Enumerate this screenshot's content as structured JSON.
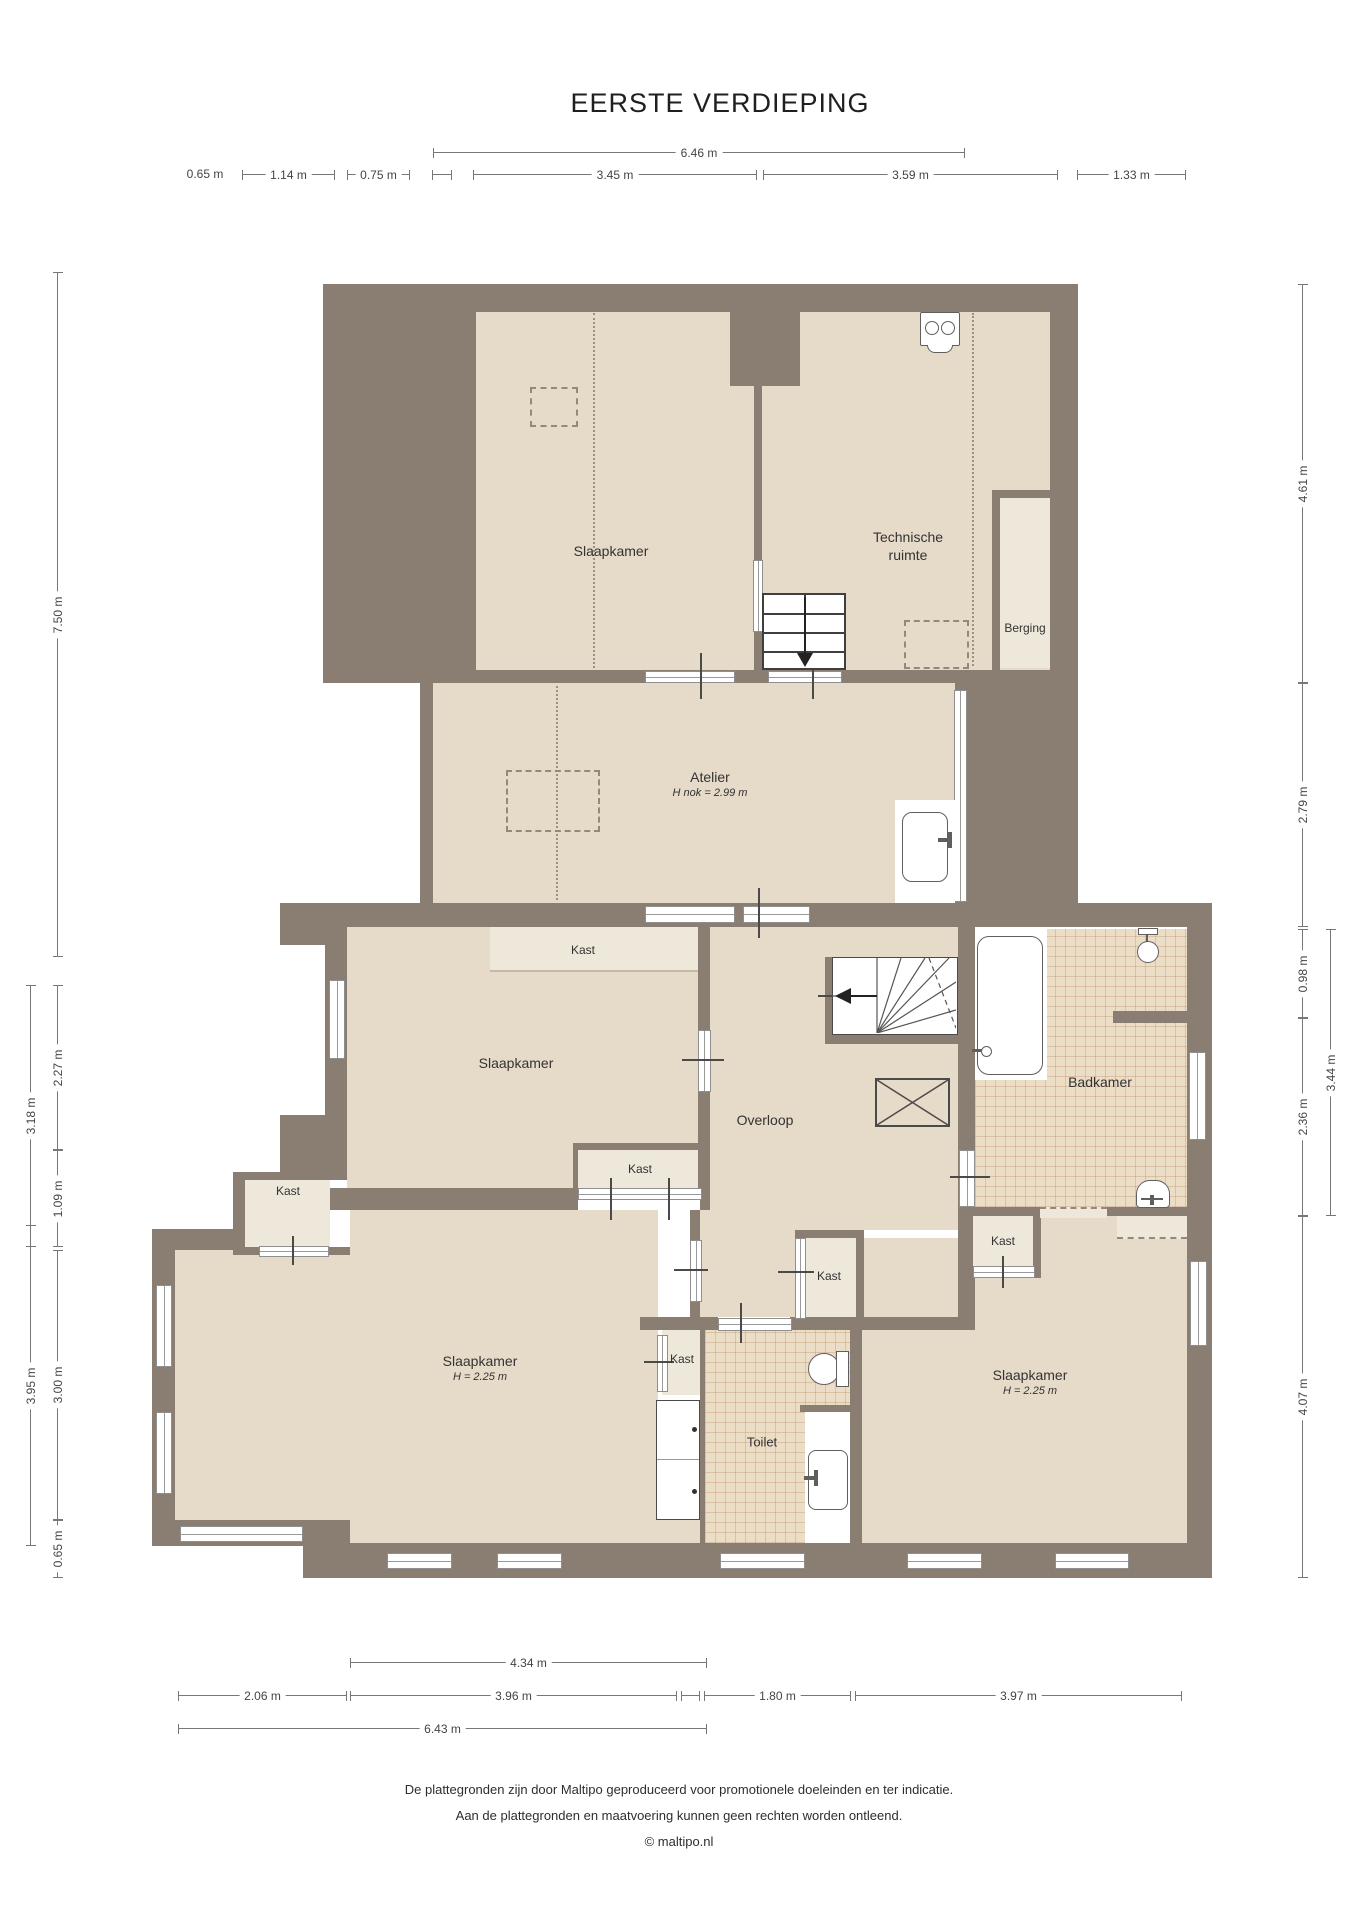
{
  "title": "EERSTE VERDIEPING",
  "colors": {
    "wall": "#8a7d71",
    "room": "#e6dac8",
    "room_light": "#eee8db",
    "tile": "#ecddc7",
    "fixture_outline": "#5f5f5f",
    "dim_line": "#777777",
    "text": "#333333"
  },
  "rooms": [
    {
      "id": "slaapkamer-top",
      "label": "Slaapkamer"
    },
    {
      "id": "technische-ruimte",
      "label": "Technische ruimte"
    },
    {
      "id": "berging",
      "label": "Berging"
    },
    {
      "id": "atelier",
      "label": "Atelier",
      "sublabel": "H nok = 2.99 m"
    },
    {
      "id": "slaapkamer-mid",
      "label": "Slaapkamer"
    },
    {
      "id": "overloop",
      "label": "Overloop"
    },
    {
      "id": "badkamer",
      "label": "Badkamer"
    },
    {
      "id": "slaapkamer-left",
      "label": "Slaapkamer",
      "sublabel": "H = 2.25 m"
    },
    {
      "id": "slaapkamer-right",
      "label": "Slaapkamer",
      "sublabel": "H = 2.25 m"
    },
    {
      "id": "toilet",
      "label": "Toilet"
    }
  ],
  "closets": {
    "label": "Kast"
  },
  "dims": {
    "top": [
      {
        "label": "6.46 m"
      },
      {
        "label": "0.65 m"
      },
      {
        "label": "1.14 m"
      },
      {
        "label": "0.75 m"
      },
      {
        "label": "3.45 m"
      },
      {
        "label": "3.59 m"
      },
      {
        "label": "1.33 m"
      }
    ],
    "bottom": [
      {
        "label": "4.34 m"
      },
      {
        "label": "2.06 m"
      },
      {
        "label": "3.96 m"
      },
      {
        "label": "1.80 m"
      },
      {
        "label": "3.97 m"
      },
      {
        "label": "6.43 m"
      }
    ],
    "left": [
      {
        "label": "7.50 m"
      },
      {
        "label": "3.18 m"
      },
      {
        "label": "2.27 m"
      },
      {
        "label": "1.09 m"
      },
      {
        "label": "3.95 m"
      },
      {
        "label": "3.00 m"
      },
      {
        "label": "0.65 m"
      }
    ],
    "right": [
      {
        "label": "4.61 m"
      },
      {
        "label": "2.79 m"
      },
      {
        "label": "0.98 m"
      },
      {
        "label": "3.44 m"
      },
      {
        "label": "2.36 m"
      },
      {
        "label": "4.07 m"
      }
    ]
  },
  "footer": {
    "line1": "De plattegronden zijn door Maltipo geproduceerd voor promotionele doeleinden en ter indicatie.",
    "line2": "Aan de plattegronden en maatvoering kunnen geen rechten worden ontleend.",
    "line3": "© maltipo.nl"
  }
}
